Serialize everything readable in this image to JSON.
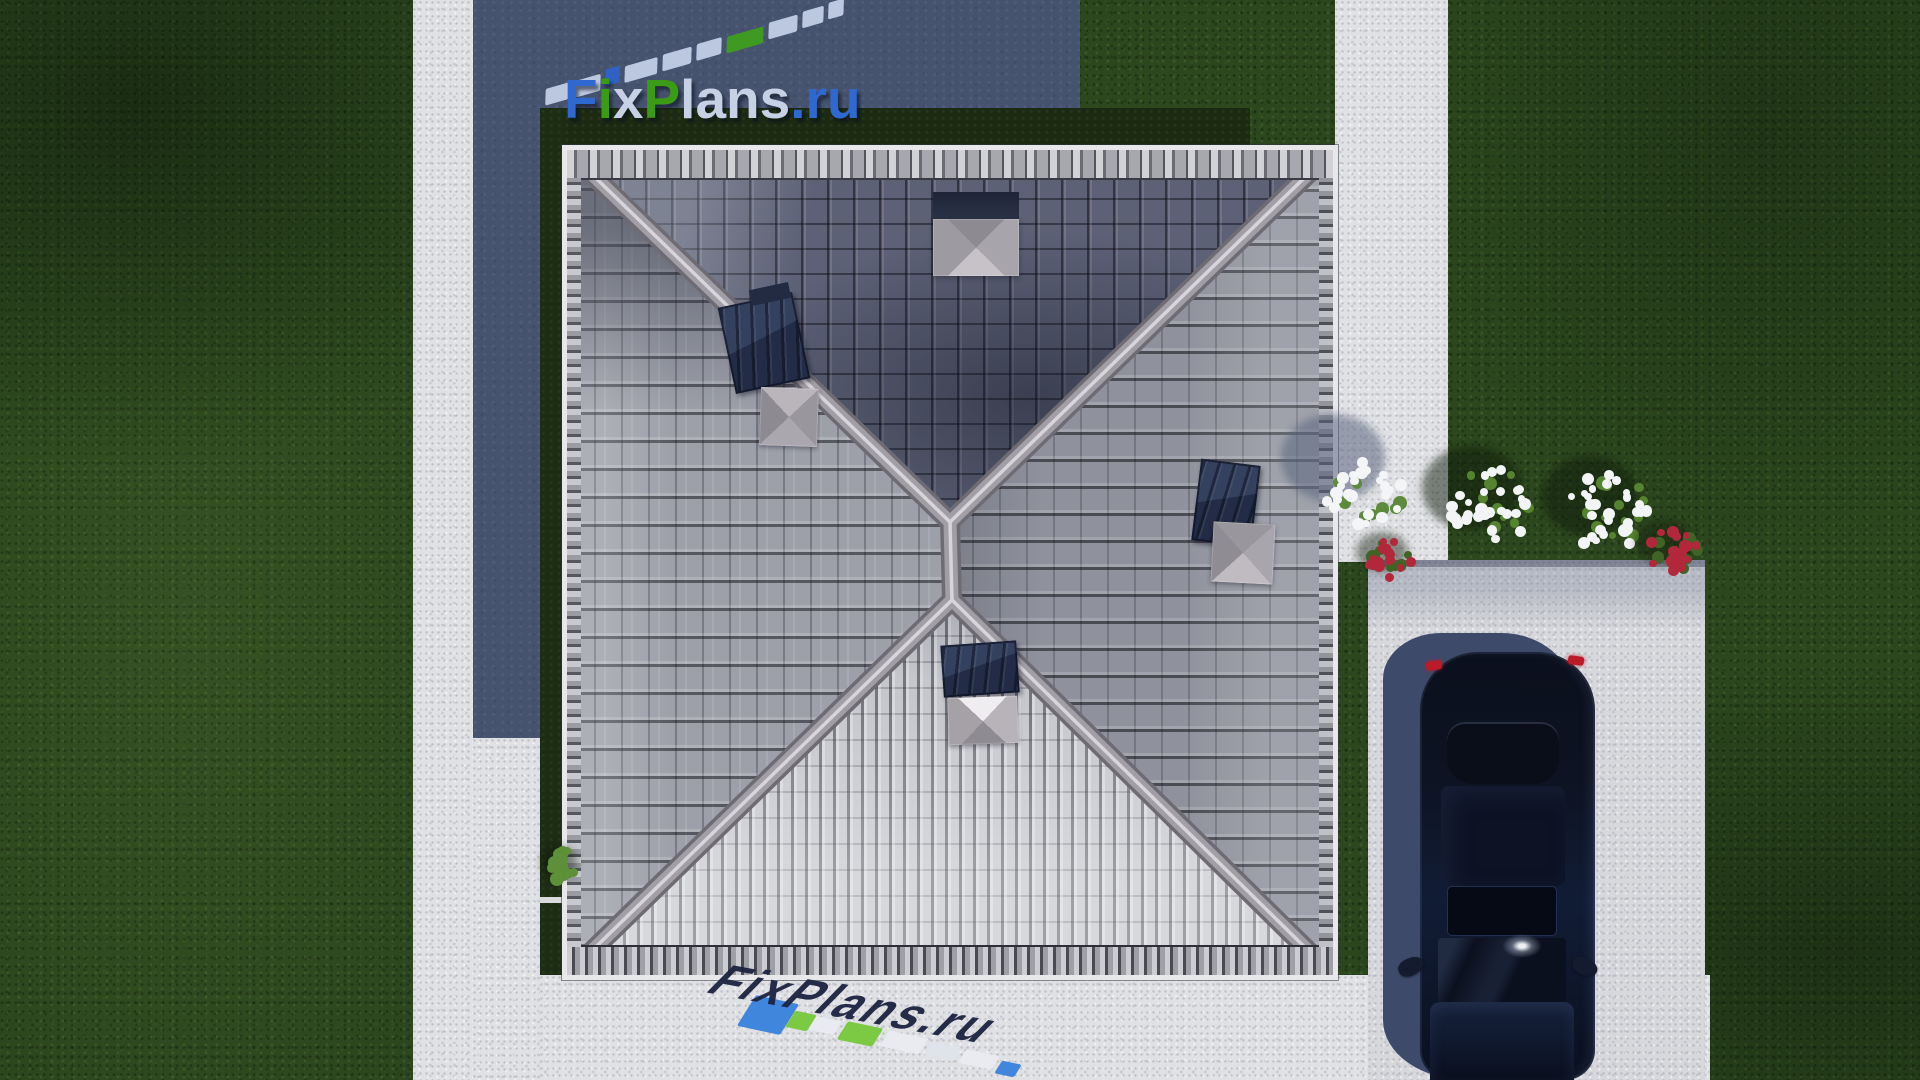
{
  "watermark": {
    "brand": "FixPlans.ru",
    "letters": [
      {
        "ch": "F",
        "color": "#2e68d0"
      },
      {
        "ch": "i",
        "color": "#3c9b14"
      },
      {
        "ch": "x",
        "color": "#c7d1e6"
      },
      {
        "ch": "P",
        "color": "#3c9b14"
      },
      {
        "ch": "l",
        "color": "#c7d1e6"
      },
      {
        "ch": "a",
        "color": "#c7d1e6"
      },
      {
        "ch": "n",
        "color": "#c7d1e6"
      },
      {
        "ch": "s",
        "color": "#c7d1e6"
      },
      {
        "ch": ".",
        "color": "#2e68d0"
      },
      {
        "ch": "r",
        "color": "#2e68d0"
      },
      {
        "ch": "u",
        "color": "#2e68d0"
      }
    ],
    "top_reflection": {
      "colors": {
        "pale": "#c3cfe6",
        "blue": "#2e63c8",
        "green": "#3f9e1e"
      },
      "sequence": [
        "pale",
        "pale",
        "blue",
        "pale",
        "pale",
        "pale",
        "green",
        "pale",
        "pale",
        "pale"
      ],
      "widths": [
        24,
        28,
        15,
        34,
        30,
        26,
        38,
        30,
        22,
        16
      ],
      "start_x": 545,
      "start_y": 86,
      "slope": -0.3
    },
    "bottom_reflection": {
      "text": "FixPlans.ru",
      "chips": [
        {
          "x": 746,
          "y": 998,
          "w": 44,
          "h": 34,
          "color": "#3f86dc",
          "rot": 12
        },
        {
          "x": 790,
          "y": 1012,
          "w": 22,
          "h": 18,
          "color": "#7cc944",
          "rot": 12
        },
        {
          "x": 812,
          "y": 1018,
          "w": 26,
          "h": 15,
          "color": "#e9ebf0",
          "rot": 12
        },
        {
          "x": 842,
          "y": 1024,
          "w": 36,
          "h": 20,
          "color": "#7cc944",
          "rot": 12
        },
        {
          "x": 884,
          "y": 1034,
          "w": 40,
          "h": 17,
          "color": "#e9ebf0",
          "rot": 12
        },
        {
          "x": 928,
          "y": 1044,
          "w": 30,
          "h": 15,
          "color": "#dfe3ea",
          "rot": 12
        },
        {
          "x": 962,
          "y": 1052,
          "w": 34,
          "h": 15,
          "color": "#e9ebf0",
          "rot": 12
        },
        {
          "x": 998,
          "y": 1062,
          "w": 20,
          "h": 14,
          "color": "#3f86dc",
          "rot": 12
        }
      ]
    }
  },
  "scene": {
    "colors": {
      "grass": "#2c471e",
      "grass_shadowed": "#1c2a14",
      "concrete": "#e0e1e4",
      "cast_shadow": "#46536f",
      "roof_north_face": "#5c6175",
      "roof_west_face": "#9da0a9",
      "roof_east_face": "#8f929c",
      "roof_south_face": "#c6c7cd",
      "ridge": "#a29ea5",
      "fascia": "#e8e8eb",
      "skylight": "#2b3750",
      "car_body": "#0d1322",
      "car_taillight": "#bb1a28"
    },
    "bushes": [
      {
        "name": "white-flower-bush-on-path",
        "cx": 1363,
        "cy": 492,
        "r": 40,
        "petals": 26,
        "leaves": 10,
        "petal_color": "#f3f5f7",
        "leaf_color": "#5d8a3c",
        "shadow": {
          "dx": -30,
          "dy": -34,
          "rx": 52,
          "ry": 44,
          "color": "rgba(90,100,125,0.55)"
        }
      },
      {
        "name": "white-flower-bush-lawn-1",
        "cx": 1492,
        "cy": 506,
        "r": 42,
        "petals": 28,
        "leaves": 12,
        "petal_color": "#f2f4f6",
        "leaf_color": "#55832f",
        "shadow": {
          "dx": -20,
          "dy": -18,
          "rx": 50,
          "ry": 42,
          "color": "rgba(14,26,10,0.5)"
        }
      },
      {
        "name": "white-flower-bush-lawn-2",
        "cx": 1608,
        "cy": 512,
        "r": 42,
        "petals": 28,
        "leaves": 12,
        "petal_color": "#f2f4f6",
        "leaf_color": "#55832f",
        "shadow": {
          "dx": -18,
          "dy": -16,
          "rx": 48,
          "ry": 40,
          "color": "rgba(14,26,10,0.5)"
        }
      },
      {
        "name": "red-flower-bush-left",
        "cx": 1390,
        "cy": 560,
        "r": 24,
        "petals": 16,
        "leaves": 8,
        "petal_color": "#b3273b",
        "leaf_color": "#3f6426",
        "shadow": {
          "dx": -8,
          "dy": -8,
          "rx": 26,
          "ry": 20,
          "color": "rgba(20,30,14,0.45)"
        }
      },
      {
        "name": "red-flower-bush-right",
        "cx": 1672,
        "cy": 550,
        "r": 26,
        "petals": 18,
        "leaves": 9,
        "petal_color": "#b3273b",
        "leaf_color": "#3f6426",
        "shadow": {
          "dx": -8,
          "dy": -8,
          "rx": 28,
          "ry": 22,
          "color": "rgba(20,30,14,0.45)"
        }
      },
      {
        "name": "green-shrub-left-strip",
        "cx": 563,
        "cy": 866,
        "r": 17,
        "petals": 0,
        "leaves": 16,
        "petal_color": "#7ab04f",
        "leaf_color": "#5d9038",
        "shadow": {
          "dx": -4,
          "dy": -4,
          "rx": 18,
          "ry": 16,
          "color": "rgba(10,18,8,0.4)"
        }
      }
    ]
  }
}
